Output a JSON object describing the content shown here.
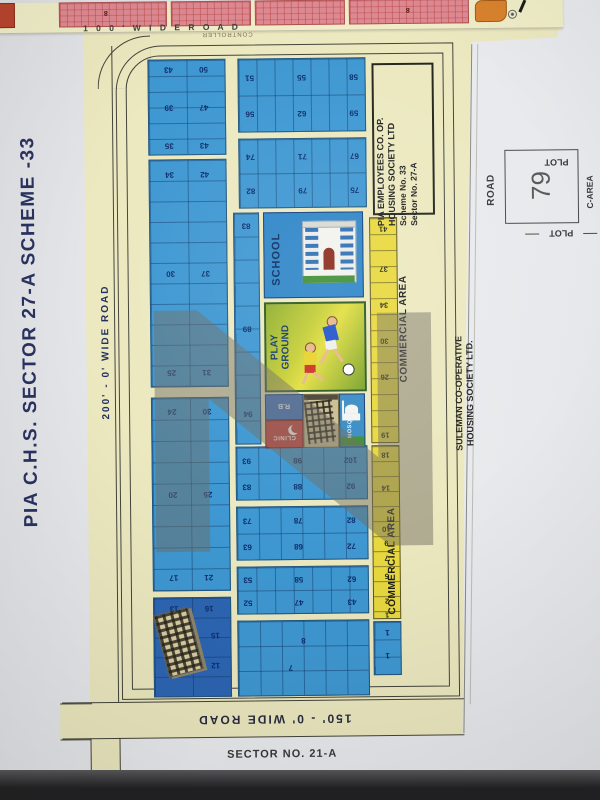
{
  "watermark": {
    "letter": "Z"
  },
  "page": {
    "title": "PIA C.H.S. SECTOR 27-A SCHEME -33",
    "sector_label": "SECTOR NO. 21-A"
  },
  "roads": {
    "top": "1 0 0 '  W I D E  R O A D",
    "top_secondary": "CONTROLLER",
    "left": "200' - 0' WIDE ROAD",
    "bottom": "150' - 0' WIDE ROAD"
  },
  "right_box": {
    "lines": [
      "PIA EMPLOYEES CO. OP.",
      "HOUSING SOCIETY LTD",
      "Scheme No. 33",
      "Sector No. 27-A"
    ]
  },
  "suleman": {
    "lines": [
      "SULEMAN CO-OPERATIVE",
      "HOUSING SOCIETY LTD."
    ]
  },
  "commercial_area_label": "COMMERCIAL AREA",
  "amenities": {
    "school": "SCHOOL",
    "playground": [
      "PLAY",
      "GROUND"
    ],
    "rb": "R.B",
    "clinic": "CLINIC",
    "mosque": "MOSQUE"
  },
  "plot_diagram": {
    "number": "79",
    "road": "ROAD",
    "plot_top": "PLOT",
    "plot_bottom": "PLOT",
    "c_area": "C-AREA"
  },
  "adjacent_strip": {
    "labels": [
      "8",
      "8"
    ]
  },
  "plot_numbers": {
    "A1": [
      "43",
      "50",
      "39",
      "47",
      "35",
      "43"
    ],
    "A2": [
      "34",
      "42",
      "30",
      "37",
      "25",
      "31"
    ],
    "A3": [
      "24",
      "30",
      "20",
      "25",
      "17",
      "21"
    ],
    "A4": [
      "13",
      "16",
      "15",
      "12"
    ],
    "B_strip": [
      "83",
      "89",
      "94"
    ],
    "BC1": [
      "51",
      "55",
      "58",
      "56",
      "62",
      "59"
    ],
    "BC2": [
      "74",
      "71",
      "67",
      "82",
      "79",
      "75"
    ],
    "MG1": [
      "93",
      "98",
      "102",
      "83",
      "88",
      "92"
    ],
    "MG2": [
      "73",
      "78",
      "82",
      "63",
      "68",
      "72"
    ],
    "MG3": [
      "53",
      "58",
      "62",
      "52",
      "47",
      "43"
    ],
    "MG4": [
      "8",
      "7"
    ],
    "RB1": [
      "1",
      "1"
    ]
  },
  "commercial_numbers": {
    "strip1": [
      "41",
      "37",
      "34",
      "30",
      "26",
      "19"
    ],
    "strip2": [
      "18",
      "14",
      "10",
      "9",
      "7",
      "5",
      "2",
      "1"
    ]
  }
}
